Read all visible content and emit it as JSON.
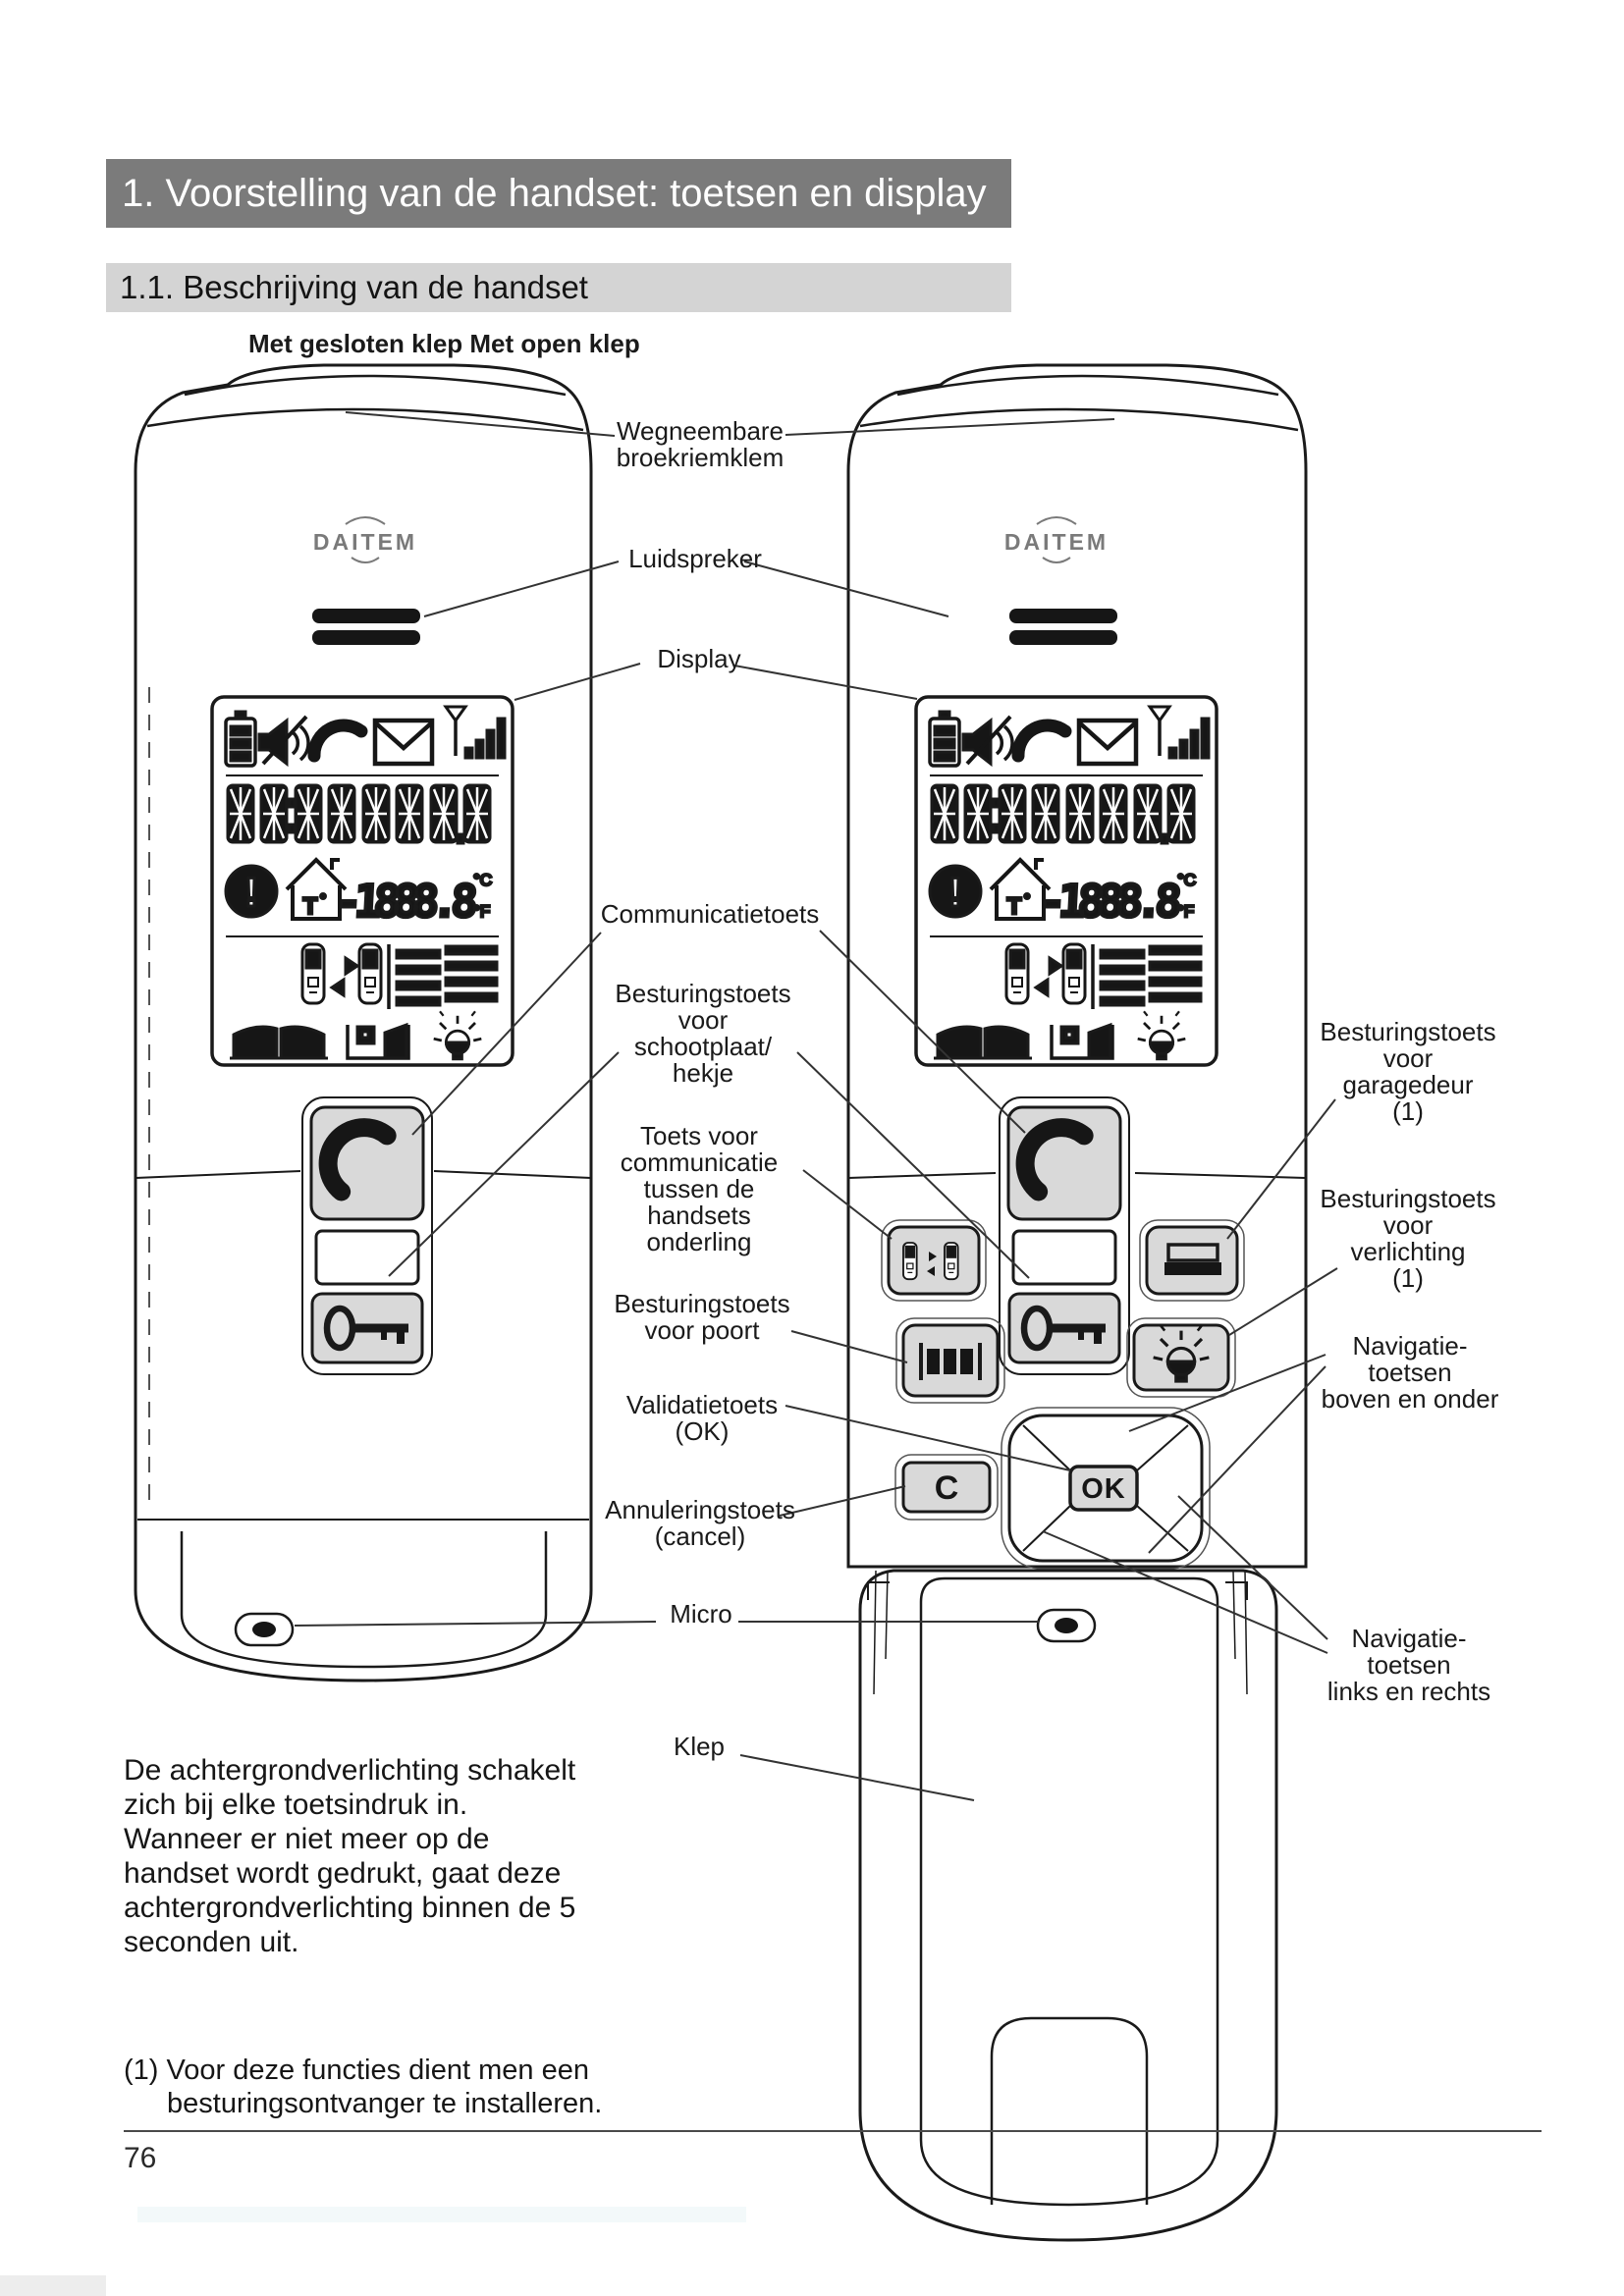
{
  "page": {
    "title": "1. Voorstelling van de handset: toetsen en display",
    "subtitle": "1.1. Beschrijving van de handset",
    "diagram_heading": "Met gesloten klep Met open klep",
    "paragraph": "De achtergrondverlichting schakelt\nzich bij elke toetsindruk in.\nWanneer er niet meer op de\nhandset wordt gedrukt, gaat deze\nachtergrondverlichting binnen de 5\nseconden uit.",
    "footnote": "(1) Voor deze functies dient men een\nbesturingsontvanger te installeren.",
    "page_number": "76"
  },
  "handset": {
    "brand": "DAITEM",
    "warning_mark": "!",
    "house_sensor": "T",
    "lcd_temperature": "-1888.8",
    "lcd_celsius": "°C",
    "lcd_fahrenheit": "°F",
    "ok_key": "OK",
    "cancel_key": "C"
  },
  "labels": {
    "clip": "Wegneembare\nbroekriemklem",
    "speaker": "Luidspreker",
    "display": "Display",
    "communication": "Communicatietoets",
    "latch": "Besturingstoets\nvoor\nschootplaat/\nhekje",
    "intercom": "Toets voor\ncommunicatie\ntussen de\nhandsets\nonderling",
    "gate": "Besturingstoets\nvoor poort",
    "validation": "Validatietoets\n(OK)",
    "cancel": "Annuleringstoets\n(cancel)",
    "micro": "Micro",
    "flap": "Klep",
    "garage": "Besturingstoets\nvoor\ngaragedeur\n(1)",
    "light": "Besturingstoets\nvoor\nverlichting\n(1)",
    "nav_vertical": "Navigatie-\ntoetsen\nboven en onder",
    "nav_horizontal": "Navigatie-\ntoetsen\nlinks en rechts"
  },
  "colors": {
    "title_bar_bg": "#7b7b7b",
    "subtitle_bar_bg": "#d4d4d4",
    "button_fill": "#d9d9d9",
    "line_art": "#1a1a1a"
  }
}
